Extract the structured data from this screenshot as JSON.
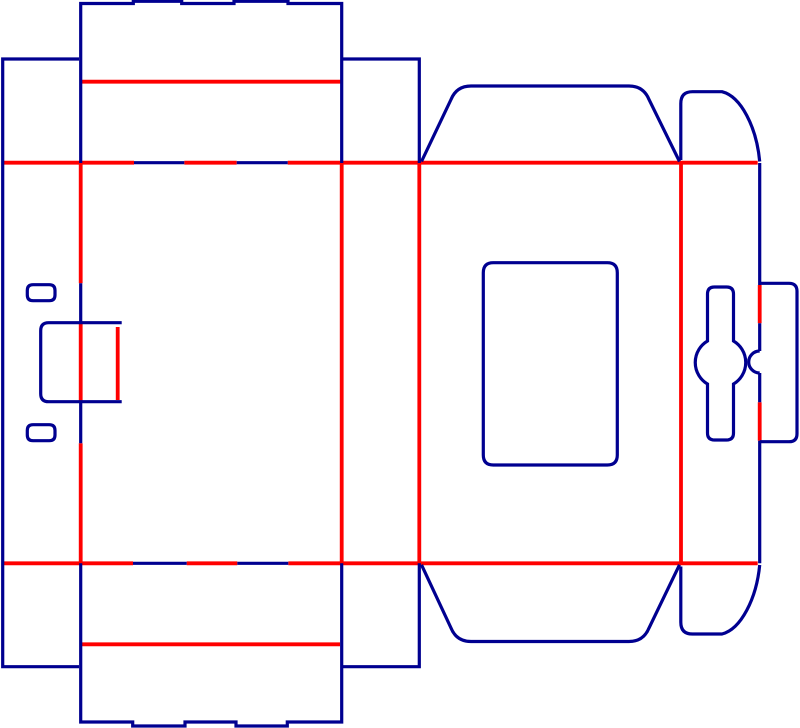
{
  "canvas": {
    "width": 800,
    "height": 728,
    "background": "#ffffff"
  },
  "styles": {
    "cut_color": "#000090",
    "crease_color": "#ff0000",
    "cut_width": 3.2,
    "crease_width": 3.8
  },
  "dieline": {
    "elements": [
      {
        "name": "top-fold-crease",
        "type": "crease",
        "d": "M 2.7 162.7 L 134 162.7 M 184.3 162.7 L 236.7 162.7 M 287.7 162.7 L 757.7 162.7"
      },
      {
        "name": "bottom-fold-crease",
        "type": "crease",
        "d": "M 2.7 563.3 L 133 563.3 M 186.7 563.3 L 237.3 563.3 M 288.3 563.3 L 757.7 563.3"
      },
      {
        "name": "glue-fold-crease",
        "type": "crease",
        "d": "M 80.7 163 L 80.7 283.3 M 80.7 323.3 L 80.7 401.7 M 80.7 443.3 L 80.7 563.3"
      },
      {
        "name": "panel-fold-crease-1",
        "type": "crease",
        "d": "M 341.7 163 L 341.7 563.3"
      },
      {
        "name": "panel-fold-crease-2",
        "type": "crease",
        "d": "M 419.3 163 L 419.3 563.3"
      },
      {
        "name": "panel-fold-crease-3",
        "type": "crease",
        "d": "M 681 163 L 681 563.3"
      },
      {
        "name": "lock-hinge-crease",
        "type": "crease",
        "d": "M 759.7 285 L 759.7 323.3 M 759.7 402.3 L 759.7 440.7"
      },
      {
        "name": "top-tuck-flap-crease",
        "type": "crease",
        "d": "M 81 81.7 L 341 81.7"
      },
      {
        "name": "bottom-tuck-flap-crease",
        "type": "crease",
        "d": "M 81.7 644.3 L 340 644.3"
      },
      {
        "name": "side-tab-crease",
        "type": "crease",
        "d": "M 117.7 327 L 117.7 400"
      },
      {
        "name": "glue-strip-outline",
        "type": "cut",
        "d": "M 79 59 L 2.7 59 L 2.7 666.7 L 79 666.7"
      },
      {
        "name": "top-tuck-flap-outline",
        "type": "cut",
        "d": "M 80.7 163 L 80.7 3.5 L 133.3 3.5 L 133.3 1.3 L 181.7 1.3 L 181.7 3.5 L 234 3.5 L 234 1.3 L 288 1.3 L 288 3.5 L 341.7 3.5 L 341.7 163"
      },
      {
        "name": "top-right-strip-outline",
        "type": "cut",
        "d": "M 341.7 59 L 419.3 59 L 419.3 163"
      },
      {
        "name": "top-dust-flap-outline",
        "type": "cut",
        "d": "M 421.5 161.5 L 451 99.5 Q 456.5 86 471 86 L 629 86 Q 643.5 86 649 99.5 L 679.5 161.5"
      },
      {
        "name": "top-rounded-flap-outline",
        "type": "cut",
        "d": "M 680.8 160 L 680.8 103.5 Q 680.8 91.7 692.5 91.7 L 722 91.7 C 741 96.5 756.5 127 759.7 161.5"
      },
      {
        "name": "top-fold-cut-slit-a",
        "type": "cut",
        "d": "M 134 162.7 L 184.3 162.7"
      },
      {
        "name": "top-fold-cut-slit-b",
        "type": "cut",
        "d": "M 236.7 162.7 L 287.7 162.7"
      },
      {
        "name": "bottom-fold-cut-slit-a",
        "type": "cut",
        "d": "M 133 563.3 L 186.7 563.3"
      },
      {
        "name": "bottom-fold-cut-slit-b",
        "type": "cut",
        "d": "M 237.3 563.3 L 288.3 563.3"
      },
      {
        "name": "glue-fold-cut-segments",
        "type": "cut",
        "d": "M 80.7 283.3 L 80.7 323.3 M 80.7 401.7 L 80.7 443.3"
      },
      {
        "name": "slot-top-outline",
        "type": "cut",
        "d": "M 33 284.7 L 49.3 284.7 Q 55 284.7 55 290.4 L 55 295 Q 55 300.7 49.3 300.7 L 33 300.7 Q 27.3 300.7 27.3 295 L 27.3 290.4 Q 27.3 284.7 33 284.7 Z"
      },
      {
        "name": "slot-bottom-outline",
        "type": "cut",
        "d": "M 33 424.7 L 49.3 424.7 Q 55 424.7 55 430.4 L 55 435 Q 55 440.7 49.3 440.7 L 33 440.7 Q 27.3 440.7 27.3 435 L 27.3 430.4 Q 27.3 424.7 33 424.7 Z"
      },
      {
        "name": "side-tab-outline",
        "type": "cut",
        "d": "M 121.7 322.7 L 48.7 322.7 Q 40.7 322.7 40.7 330.7 L 40.7 393.7 Q 40.7 401.7 48.7 401.7 L 121.7 401.7"
      },
      {
        "name": "window-outline",
        "type": "cut",
        "d": "M 493.3 262.7 L 607.3 262.7 Q 617.3 262.7 617.3 272.7 L 617.3 455 Q 617.3 465 607.3 465 L 493.3 465 Q 483.3 465 483.3 455 L 483.3 272.7 Q 483.3 262.7 493.3 262.7 Z"
      },
      {
        "name": "lock-slit-cut-segments",
        "type": "cut",
        "d": "M 759.7 163 L 759.7 285 M 759.7 323.3 L 759.7 351 M 759.7 373 L 759.7 402.3 M 759.7 440.7 L 759.7 563.3"
      },
      {
        "name": "thumb-notch-cut",
        "type": "cut",
        "d": "M 759.7 351 A 11 11 0 0 0 759.7 373"
      },
      {
        "name": "lock-flap-outline",
        "type": "cut",
        "d": "M 759.7 283.3 L 789 283.3 Q 797 283.3 797 291.3 L 797 433.7 Q 797 441.7 789 441.7 L 759.7 441.7"
      },
      {
        "name": "lock-tab-outline",
        "type": "cut",
        "d": "M 707.5 294 Q 707.5 287 714.5 287 L 726.5 287 Q 733.5 287 733.5 294 L 733.5 341 A 25 25 0 0 1 733.5 384 L 733.5 433 Q 733.5 440 726.5 440 L 714.5 440 Q 707.5 440 707.5 433 L 707.5 384 A 25 25 0 0 1 707.5 341 Z"
      },
      {
        "name": "bottom-tuck-flap-outline",
        "type": "cut",
        "d": "M 80.7 563.3 L 80.7 722 L 132.7 722 L 132.7 726 L 185 726 L 185 722 L 236 722 L 236 726 L 287.3 726 L 287.3 722 L 341.7 722 L 341.7 563.3"
      },
      {
        "name": "bottom-right-strip-outline",
        "type": "cut",
        "d": "M 341.7 666.7 L 419.3 666.7 L 419.3 563.3"
      },
      {
        "name": "bottom-dust-flap-outline",
        "type": "cut",
        "d": "M 421.5 564.8 L 451 628 Q 456.5 641.5 471 641.5 L 629 641.5 Q 643.5 641.5 649 628 L 679.5 564.8"
      },
      {
        "name": "bottom-rounded-flap-outline",
        "type": "cut",
        "d": "M 680.8 566.5 L 680.8 622.2 Q 680.8 634 692.5 634 L 722 634 C 741 629.2 756.5 598.5 759.7 565"
      }
    ]
  }
}
